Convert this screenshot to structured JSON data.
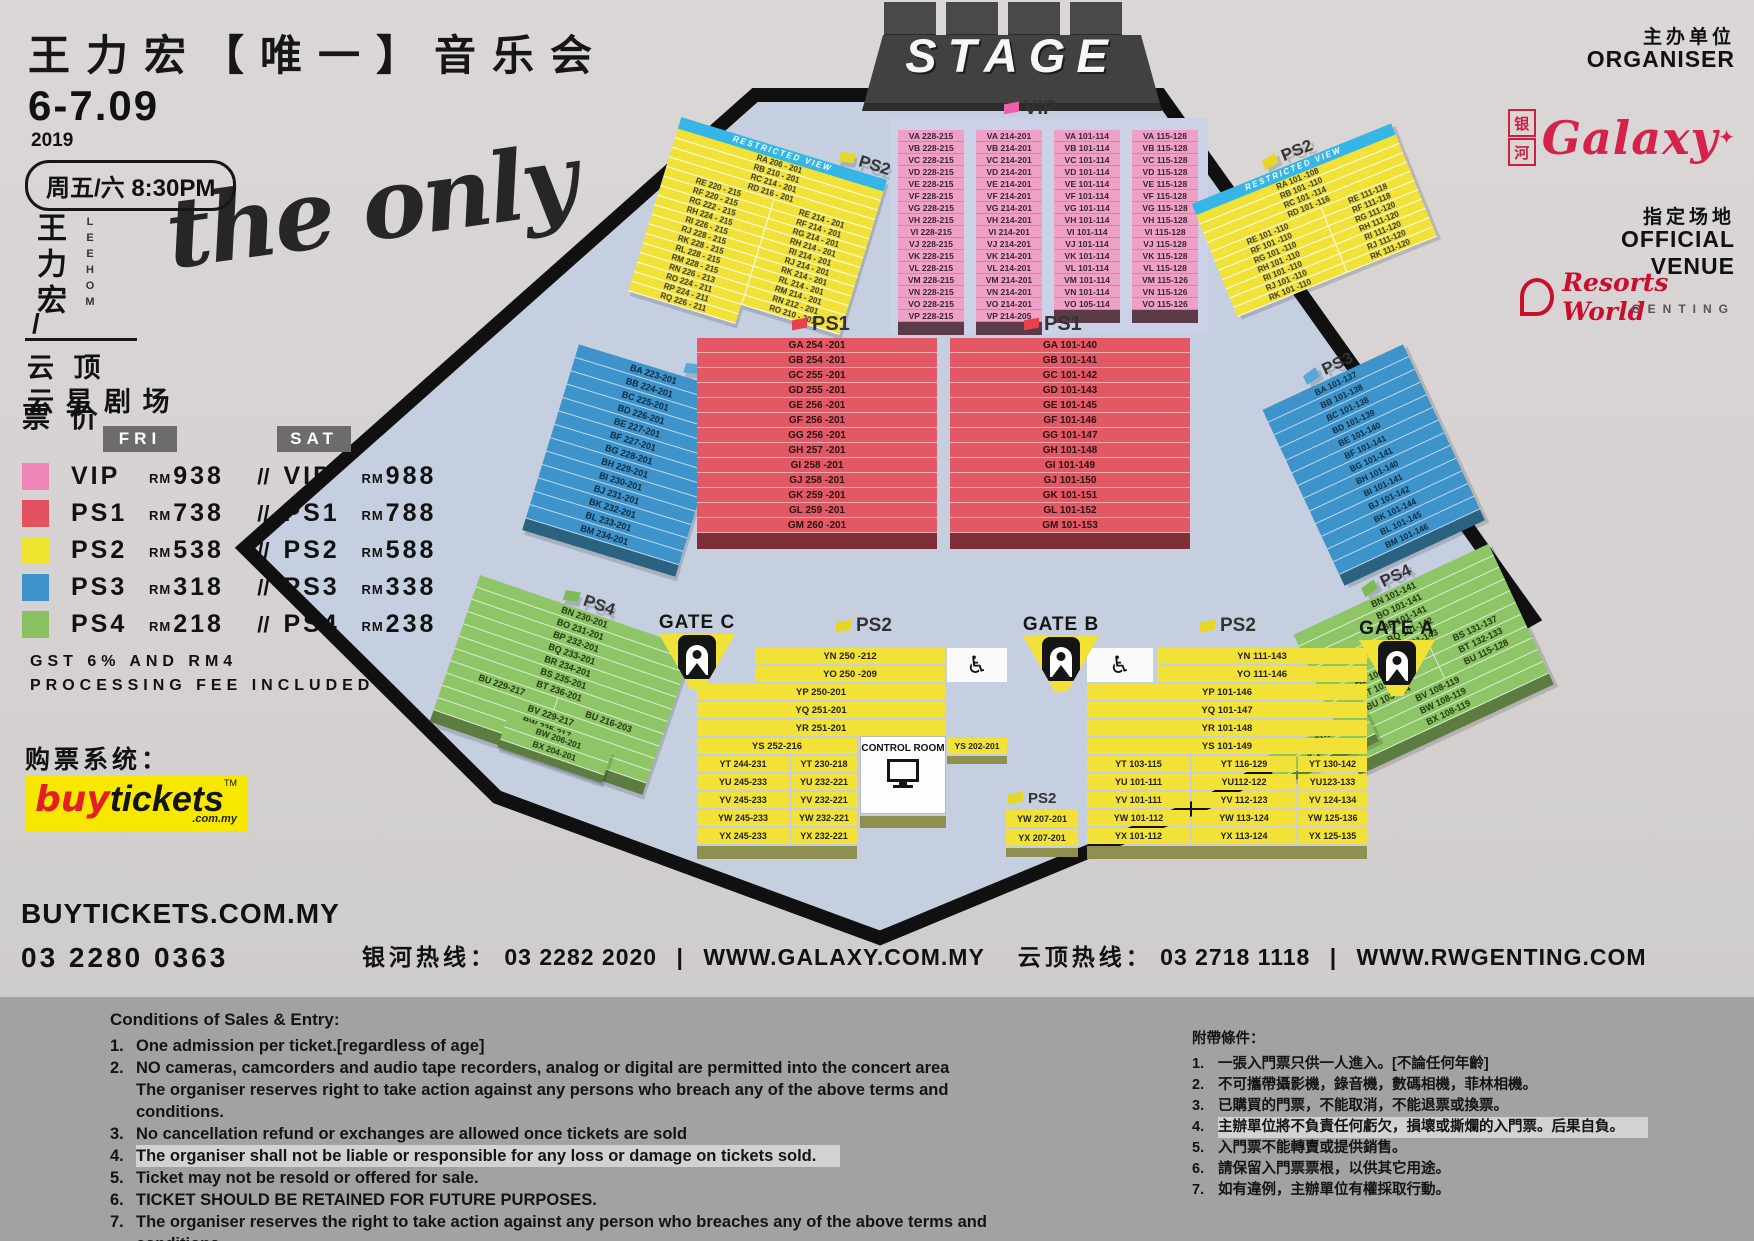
{
  "header": {
    "title": "王力宏【唯一】音乐会",
    "date": "6-7.09",
    "year": "2019",
    "time": "周五/六 8:30PM",
    "artist_cn": "王力宏",
    "artist_slash": "/",
    "artist_en": "LEEHOM",
    "venue1": "云 顶",
    "venue2": "云 星 剧 场",
    "script_art": "the only"
  },
  "pricing": {
    "heading": "票 价",
    "fri": "FRI",
    "sat": "SAT",
    "rm": "RM",
    "sep": "//",
    "rows": [
      {
        "cat": "VIP",
        "fri": "938",
        "sat": "988",
        "color": "#ef86ba"
      },
      {
        "cat": "PS1",
        "fri": "738",
        "sat": "788",
        "color": "#e25160"
      },
      {
        "cat": "PS2",
        "fri": "538",
        "sat": "588",
        "color": "#f0e52f"
      },
      {
        "cat": "PS3",
        "fri": "318",
        "sat": "338",
        "color": "#3e93cc"
      },
      {
        "cat": "PS4",
        "fri": "218",
        "sat": "238",
        "color": "#8cc163"
      }
    ]
  },
  "notes": {
    "l1": "GST 6% AND RM4",
    "l2": "PROCESSING FEE INCLUDED"
  },
  "buy": {
    "heading": "购票系统：",
    "logo": {
      "buy": "buy",
      "tickets": "tickets",
      "tm": "TM",
      "domain": ".com.my"
    },
    "site": "BUYTICKETS.COM.MY",
    "phone": "03 2280 0363"
  },
  "hotline": {
    "galaxy_label": "银河热线：",
    "galaxy_phone": "03 2282 2020",
    "bar1": "|",
    "galaxy_site": "WWW.GALAXY.COM.MY",
    "genting_label": "云顶热线：",
    "genting_phone": "03 2718 1118",
    "bar2": "|",
    "genting_site": "WWW.RWGENTING.COM"
  },
  "org": {
    "label_cn": "主办单位",
    "label_en": "ORGANISER",
    "galaxy_cn1": "银",
    "galaxy_cn2": "河",
    "galaxy_script": "Galaxy",
    "galaxy_star": "✦",
    "venue_label_cn": "指定场地",
    "venue_label_en": "OFFICIAL VENUE",
    "rw_script": "Resorts World",
    "rw_sub": "GENTING"
  },
  "theme": {
    "vip": "#efa0c5",
    "vip_sep": "#d583ab",
    "vip_footer": "#5c3b49",
    "ps1": "#e25865",
    "ps1_footer": "#7e2e35",
    "ps2": "#f2e237",
    "ps2_footer": "#8f8f52",
    "ps3": "#3f93cb",
    "ps3_footer": "#2a6280",
    "ps4": "#8ec567",
    "ps4_footer": "#5d7c41",
    "floor": "#c6cfe0",
    "outline": "#101010",
    "flag_vip": "#ef5fa7",
    "flag_ps1": "#e8404d",
    "flag_ps2": "#e5d62a",
    "flag_ps3": "#57a7d8",
    "flag_ps4": "#7fba55",
    "banner": "#35b6e6",
    "band": "#a2a2a2",
    "highlight": "#d2d2d2"
  },
  "map": {
    "stage": "STAGE",
    "restricted": "RESTRICTED VIEW",
    "control_room": "CONTROL ROOM",
    "labels": {
      "vip": "VIP",
      "ps1": "PS1",
      "ps2": "PS2",
      "ps3": "PS3",
      "ps4": "PS4"
    },
    "gates": [
      "GATE C",
      "GATE B",
      "GATE A"
    ],
    "vip": {
      "col1": [
        "VA 228-215",
        "VB 228-215",
        "VC 228-215",
        "VD 228-215",
        "VE 228-215",
        "VF 228-215",
        "VG 228-215",
        "VH 228-215",
        "VI 228-215",
        "VJ 228-215",
        "VK 228-215",
        "VL 228-215",
        "VM 228-215",
        "VN 228-215",
        "VO 228-215",
        "VP 228-215"
      ],
      "col2": [
        "VA 214-201",
        "VB 214-201",
        "VC 214-201",
        "VD 214-201",
        "VE 214-201",
        "VF 214-201",
        "VG 214-201",
        "VH 214-201",
        "VI 214-201",
        "VJ 214-201",
        "VK 214-201",
        "VL 214-201",
        "VM 214-201",
        "VN 214-201",
        "VO 214-201",
        "VP 214-205"
      ],
      "col3": [
        "VA 101-114",
        "VB 101-114",
        "VC 101-114",
        "VD 101-114",
        "VE 101-114",
        "VF 101-114",
        "VG 101-114",
        "VH 101-114",
        "VI 101-114",
        "VJ 101-114",
        "VK 101-114",
        "VL 101-114",
        "VM 101-114",
        "VN 101-114",
        "VO 105-114"
      ],
      "col4": [
        "VA 115-128",
        "VB 115-128",
        "VC 115-128",
        "VD 115-128",
        "VE 115-128",
        "VF 115-128",
        "VG 115-128",
        "VH 115-128",
        "VI 115-128",
        "VJ 115-128",
        "VK 115-128",
        "VL 115-128",
        "VM 115-126",
        "VN 115-126",
        "VO 115-126"
      ]
    },
    "rv_left": {
      "singles": [
        "RA 206 - 201",
        "RB 210 - 201",
        "RC 214 - 201",
        "RD 216 - 201"
      ],
      "pairs": [
        [
          "RE 220 - 215",
          "RE 214 - 201"
        ],
        [
          "RF 220 - 215",
          "RF 214 - 201"
        ],
        [
          "RG 222 - 215",
          "RG 214 - 201"
        ],
        [
          "RH 224 - 215",
          "RH 214 - 201"
        ],
        [
          "RI 226 - 215",
          "RI 214 - 201"
        ],
        [
          "RJ 228 - 215",
          "RJ 214 - 201"
        ],
        [
          "RK 228 - 215",
          "RK 214 - 201"
        ],
        [
          "RL 228 - 215",
          "RL 214 - 201"
        ],
        [
          "RM 228 - 215",
          "RM 214 - 201"
        ],
        [
          "RN 226 - 213",
          "RN 212 - 201"
        ],
        [
          "RO 224 - 211",
          "RO 210 - 201"
        ],
        [
          "RP 224 - 211",
          ""
        ],
        [
          "RQ 226 - 211",
          ""
        ]
      ]
    },
    "rv_right": {
      "singles": [
        "RA 101 -108",
        "RB 101 -110",
        "RC 101 -114",
        "RD 101 -116"
      ],
      "pairs": [
        [
          "RE 101 -110",
          "RE 111-118"
        ],
        [
          "RF 101 -110",
          "RF 111-118"
        ],
        [
          "RG 101 -110",
          "RG 111-120"
        ],
        [
          "RH 101 -110",
          "RH 111-120"
        ],
        [
          "RI 101 -110",
          "RI 111-120"
        ],
        [
          "RJ 101 -110",
          "RJ 111-120"
        ],
        [
          "RK 101 -110",
          "RK 111-120"
        ]
      ]
    },
    "ps3_left": [
      "BA 223-201",
      "BB 224-201",
      "BC 225-201",
      "BD 226-201",
      "BE 227-201",
      "BF 227-201",
      "BG 228-201",
      "BH 229-201",
      "BI 230-201",
      "BJ 231-201",
      "BK 232-201",
      "BL 233-201",
      "BM 234-201"
    ],
    "ps3_right": [
      "BA 101-137",
      "BB 101-138",
      "BC 101-138",
      "BD 101-139",
      "BE 101-140",
      "BF 101-141",
      "BG 101-141",
      "BH 101-140",
      "BI 101-141",
      "BJ 101-142",
      "BK 101-144",
      "BL 101-145",
      "BM 101-146"
    ],
    "ps1_left": [
      "GA 254 -201",
      "GB 254 -201",
      "GC 255 -201",
      "GD 255 -201",
      "GE 256 -201",
      "GF 256 -201",
      "GG 256 -201",
      "GH 257 -201",
      "GI 258 -201",
      "GJ 258 -201",
      "GK 259 -201",
      "GL 259 -201",
      "GM 260 -201"
    ],
    "ps1_right": [
      "GA 101-140",
      "GB 101-141",
      "GC 101-142",
      "GD 101-143",
      "GE 101-145",
      "GF 101-146",
      "GG 101-147",
      "GH 101-148",
      "GI 101-149",
      "GJ 101-150",
      "GK 101-151",
      "GL 101-152",
      "GM 101-153"
    ],
    "ps4_left": {
      "singles1": [
        "BN 230-201",
        "BO 231-201",
        "BP 232-201",
        "BQ 233-201",
        "BR 234-201",
        "BS 235-201",
        "BT 236-201"
      ],
      "pair": [
        "BU 229-217",
        "BU 216-203"
      ],
      "singles2": [
        "BV 229-217",
        "BW 225-217",
        "BX 223-217"
      ],
      "small": [
        "BW 206-201",
        "BX 204-201"
      ]
    },
    "ps4_right": {
      "singles1": [
        "BN 101-141",
        "BO 101-141",
        "BP 101-141",
        "BQ 101-142",
        "BR 101-143"
      ],
      "pairs": [
        [
          "BS 101-130",
          "BS 131-137"
        ],
        [
          "BT 101-131",
          "BT 132-133"
        ],
        [
          "BU 103-114",
          "BU 115-128"
        ]
      ],
      "singles2": [
        "BV 108-119",
        "BW 108-119",
        "BX 108-119"
      ],
      "small": [
        "BW 101-107",
        "BX 101-107"
      ]
    },
    "ps2_bl": {
      "yn": "YN 250 -212",
      "yo": "YO 250 -209",
      "full": [
        "YP 250-201",
        "YQ 251-201",
        "YR 251-201"
      ],
      "ys": "YS 252-216",
      "ys2": "YS 202-201",
      "pairs": [
        [
          "YT 244-231",
          "YT 230-218"
        ],
        [
          "YU 245-233",
          "YU 232-221"
        ],
        [
          "YV 245-233",
          "YV 232-221"
        ],
        [
          "YW 245-233",
          "YW 232-221"
        ],
        [
          "YX 245-233",
          "YX 232-221"
        ]
      ]
    },
    "ps2_br": {
      "yn": "YN 111-143",
      "yo": "YO 111-146",
      "full": [
        "YP 101-146",
        "YQ 101-147",
        "YR 101-148",
        "YS 101-149"
      ],
      "triples": [
        [
          "YT 103-115",
          "YT 116-129",
          "YT 130-142"
        ],
        [
          "YU 101-111",
          "YU112-122",
          "YU123-133"
        ],
        [
          "YV 101-111",
          "YV 112-123",
          "YV 124-134"
        ],
        [
          "YW 101-112",
          "YW 113-124",
          "YW 125-136"
        ],
        [
          "YX 101-112",
          "YX 113-124",
          "YX 125-135"
        ]
      ]
    },
    "ps2_bc": [
      "YW 207-201",
      "YX 207-201"
    ]
  },
  "cond_en": {
    "title": "Conditions of Sales & Entry:",
    "items": [
      {
        "n": "1.",
        "t": "One admission per ticket.[regardless of age]"
      },
      {
        "n": "2.",
        "t": "NO cameras, camcorders and audio tape recorders, analog or digital are permitted into the concert area",
        "t2": "The organiser reserves right to take action against any persons who breach any of the above terms and conditions."
      },
      {
        "n": "3.",
        "t": "No cancellation  refund or exchanges are allowed once tickets are sold"
      },
      {
        "n": "4.",
        "t": "The organiser shall not be liable or responsible for any loss or damage on tickets sold.",
        "highlight": true
      },
      {
        "n": "5.",
        "t": "Ticket may not be resold or offered for sale."
      },
      {
        "n": "6.",
        "t": "TICKET SHOULD BE RETAINED FOR FUTURE PURPOSES."
      },
      {
        "n": "7.",
        "t": "The organiser reserves the right to take action against any person who breaches any of the above terms and conditions."
      }
    ]
  },
  "cond_cn": {
    "title": "附帶條件：",
    "items": [
      {
        "n": "1.",
        "t": "一張入門票只供一人進入。[不論任何年齡]"
      },
      {
        "n": "2.",
        "t": "不可攜帶攝影機，錄音機，數碼相機，菲林相機。"
      },
      {
        "n": "3.",
        "t": "已購買的門票，不能取消，不能退票或換票。"
      },
      {
        "n": "4.",
        "t": "主辦單位將不負責任何虧欠，損壞或撕爛的入門票。后果自負。",
        "highlight": true
      },
      {
        "n": "5.",
        "t": "入門票不能轉賣或提供銷售。"
      },
      {
        "n": "6.",
        "t": "請保留入門票票根，以供其它用途。"
      },
      {
        "n": "7.",
        "t": "如有違例，主辦單位有權採取行動。"
      }
    ]
  }
}
